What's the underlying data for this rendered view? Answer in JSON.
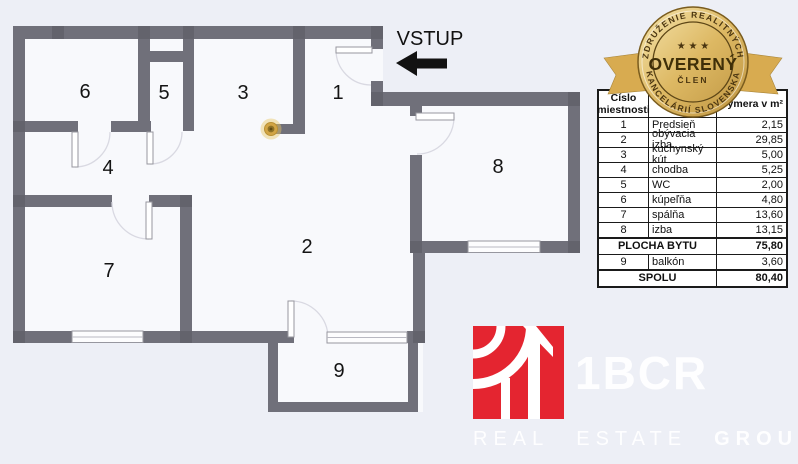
{
  "colors": {
    "page_bg": "#edeff6",
    "plan_fill": "#f8f9fc",
    "wall": "#70707a",
    "wall_dark": "#63636c",
    "accent_red": "#e42530",
    "badge_gold": "#d9ae54",
    "marker_gold": "#d2a545",
    "table_border": "#1a1a1a"
  },
  "floorplan": {
    "entrance_label": "VSTUP",
    "rooms": [
      {
        "number": "1"
      },
      {
        "number": "2"
      },
      {
        "number": "3"
      },
      {
        "number": "4"
      },
      {
        "number": "5"
      },
      {
        "number": "6"
      },
      {
        "number": "7"
      },
      {
        "number": "8"
      },
      {
        "number": "9"
      }
    ]
  },
  "table": {
    "header": {
      "col1": "Číslo miestnosti",
      "col2": "",
      "col3": "Výmera v m²"
    },
    "rows": [
      {
        "number": "1",
        "name": "Predsieň",
        "area": "2,15"
      },
      {
        "number": "2",
        "name": "obývacia izba",
        "area": "29,85"
      },
      {
        "number": "3",
        "name": "kuchynský kút",
        "area": "5,00"
      },
      {
        "number": "4",
        "name": "chodba",
        "area": "5,25"
      },
      {
        "number": "5",
        "name": "WC",
        "area": "2,00"
      },
      {
        "number": "6",
        "name": "kúpeľňa",
        "area": "4,80"
      },
      {
        "number": "7",
        "name": "spálňa",
        "area": "13,60"
      },
      {
        "number": "8",
        "name": "izba",
        "area": "13,15"
      }
    ],
    "subtotal": {
      "label": "PLOCHA BYTU",
      "area": "75,80"
    },
    "balcony_row": {
      "number": "9",
      "name": "balkón",
      "area": "3,60"
    },
    "total": {
      "label": "SPOLU",
      "area": "80,40"
    }
  },
  "badge": {
    "arc_top": "ZDRUŽENIE REALITNÝCH",
    "stars": "★ ★ ★",
    "title": "OVERENÝ",
    "member": "ČLEN",
    "arc_bottom": "KANCELÁRIÍ SLOVENSKA"
  },
  "logo": {
    "brand": "1BCR",
    "word1": "REAL",
    "word2": "ESTATE",
    "word3": "GROUP"
  }
}
